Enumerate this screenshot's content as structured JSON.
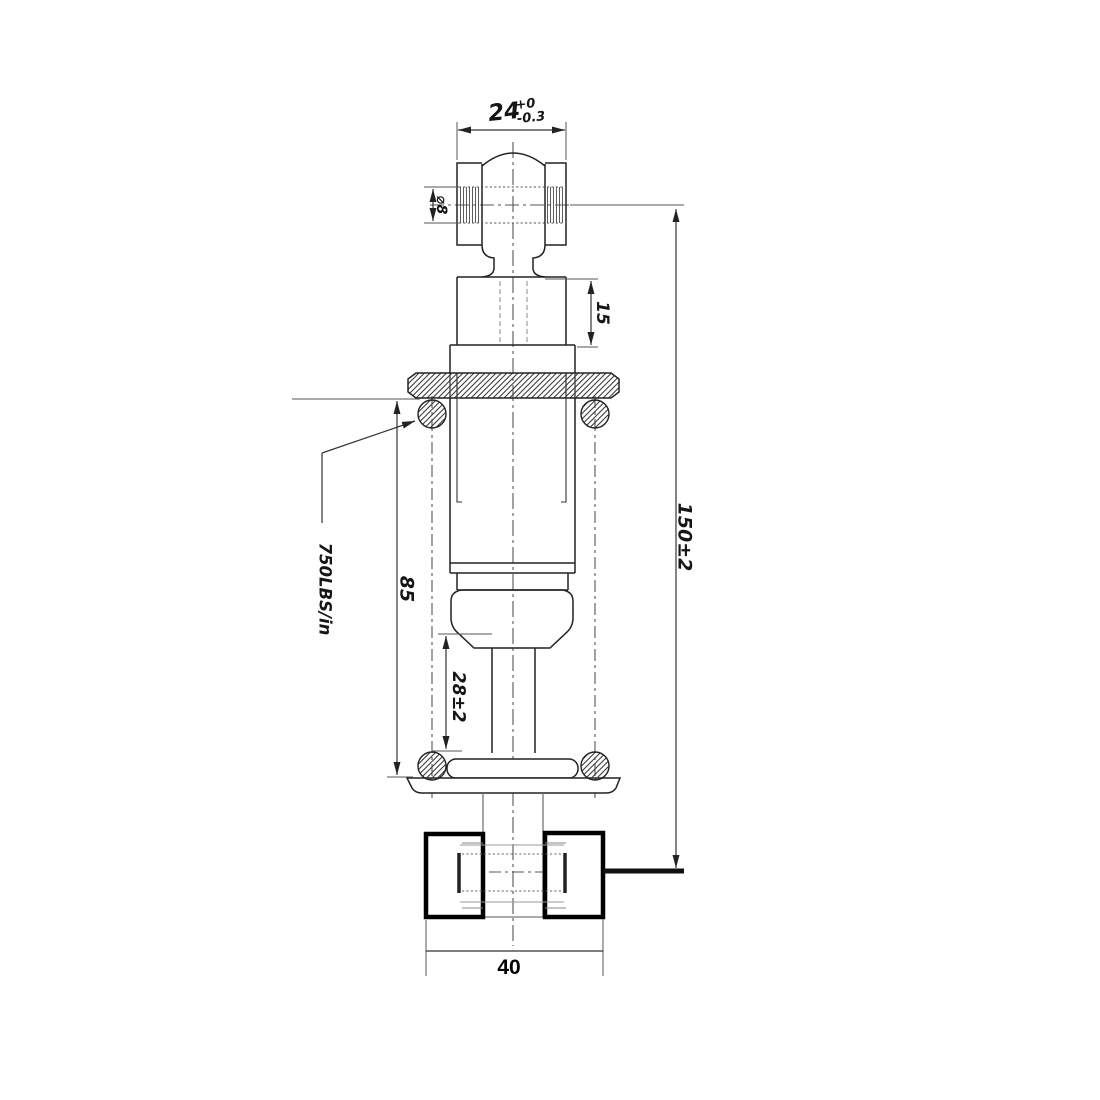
{
  "dimensions": {
    "top_width": {
      "value": "24",
      "tol_plus": "+0",
      "tol_minus": "-0.3"
    },
    "bore_diameter": "⌀8",
    "upper_section": "15",
    "overall_length": "150±2",
    "body_length": "85",
    "rod_exposed": "28±2",
    "base_width": "40",
    "spring_rate": "750LBS/in"
  }
}
